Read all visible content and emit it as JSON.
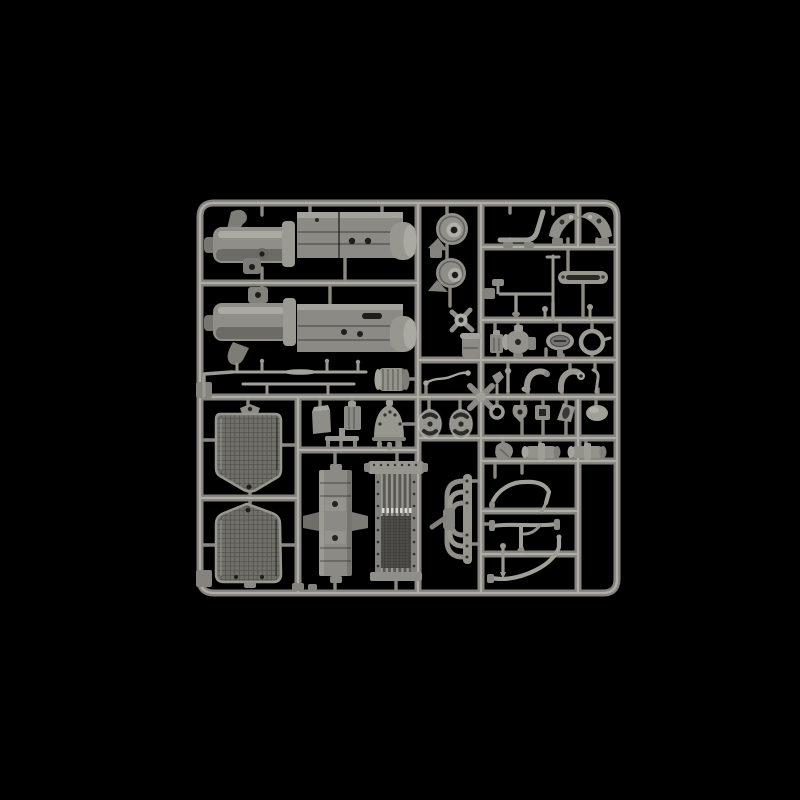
{
  "scene": {
    "type": "product-photograph",
    "subject": "injection-moulded plastic model kit sprue (parts tree), unpainted grey styrene",
    "background_description": "plain black studio backdrop",
    "no_visible_text": true
  },
  "colors": {
    "background": "#000000",
    "runner_base": "#85837d",
    "runner_highlight": "#bab8b1",
    "gate": "#8a8880",
    "plastic_light": "#b5b4ad",
    "plastic_mid": "#8f8e88",
    "plastic_dark": "#55544f",
    "recess_shadow": "#242422"
  },
  "sprue": {
    "material": "grey styrene (unpainted)",
    "layout": "rounded rectangular frame with internal runners dividing compartments of parts",
    "parts": [
      {
        "name": "engine-gearbox-assembly-upper",
        "area": "top-left"
      },
      {
        "name": "engine-gearbox-assembly-lower",
        "area": "top-left"
      },
      {
        "name": "drive-housing-cover-1",
        "area": "top-center"
      },
      {
        "name": "drive-housing-cover-2",
        "area": "top-center"
      },
      {
        "name": "fan-bracket",
        "area": "center"
      },
      {
        "name": "oil-canister",
        "area": "center"
      },
      {
        "name": "throttle-wire",
        "area": "center"
      },
      {
        "name": "curved-lever",
        "area": "top-right"
      },
      {
        "name": "fender-bracket-left",
        "area": "top-right"
      },
      {
        "name": "fender-bracket-right",
        "area": "top-right"
      },
      {
        "name": "linkage-rods",
        "area": "right"
      },
      {
        "name": "slotted-tie-rod",
        "area": "right"
      },
      {
        "name": "carburetor-body",
        "area": "right"
      },
      {
        "name": "oval-inspection-plate",
        "area": "right"
      },
      {
        "name": "ring-clamp",
        "area": "right"
      },
      {
        "name": "exhaust-elbow-pipes",
        "area": "right"
      },
      {
        "name": "small-fittings-row",
        "area": "right"
      },
      {
        "name": "pump-cylinder-1",
        "area": "right"
      },
      {
        "name": "pump-cylinder-2",
        "area": "right"
      },
      {
        "name": "tie-rods-with-pins",
        "area": "middle-left"
      },
      {
        "name": "muffler-drum",
        "area": "middle"
      },
      {
        "name": "storage-box-1",
        "area": "middle"
      },
      {
        "name": "storage-box-2",
        "area": "middle"
      },
      {
        "name": "bell-housing-dome",
        "area": "middle"
      },
      {
        "name": "oval-cam-plate-1",
        "area": "middle"
      },
      {
        "name": "oval-cam-plate-2",
        "area": "middle"
      },
      {
        "name": "radiator-shell-1",
        "area": "bottom-left"
      },
      {
        "name": "radiator-shell-2",
        "area": "bottom-left"
      },
      {
        "name": "chassis-cross-member",
        "area": "bottom-center"
      },
      {
        "name": "radiator-core",
        "area": "bottom-center"
      },
      {
        "name": "exhaust-manifold",
        "area": "bottom-center"
      },
      {
        "name": "fuel-line-pipe-1",
        "area": "bottom-right"
      },
      {
        "name": "fuel-line-pipe-2",
        "area": "bottom-right"
      },
      {
        "name": "fuel-line-pipe-3",
        "area": "bottom-right"
      }
    ]
  }
}
